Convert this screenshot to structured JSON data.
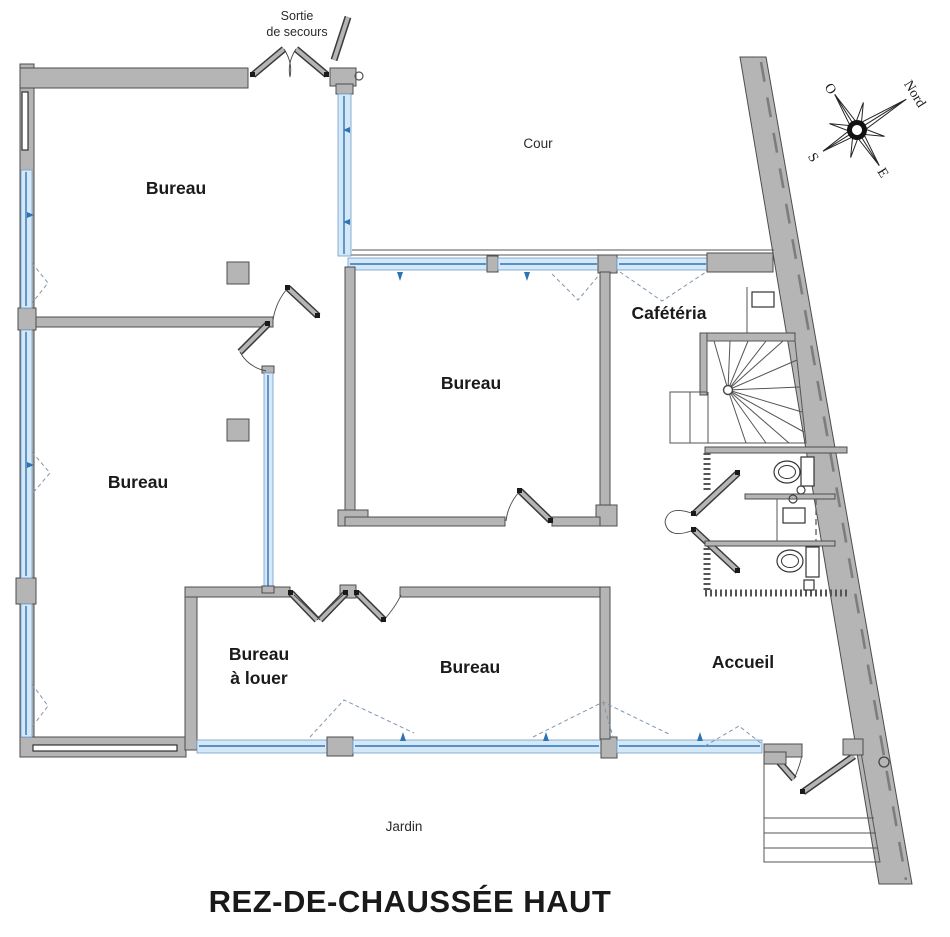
{
  "title": "REZ-DE-CHAUSSÉE HAUT",
  "outdoor": {
    "cour": "Cour",
    "jardin": "Jardin",
    "sortie_line1": "Sortie",
    "sortie_line2": "de secours"
  },
  "rooms": {
    "bureau_top_left": "Bureau",
    "bureau_left": "Bureau",
    "bureau_center": "Bureau",
    "bureau_bottom": "Bureau",
    "bureau_a_louer_line1": "Bureau",
    "bureau_a_louer_line2": "à louer",
    "cafeteria": "Cafétéria",
    "accueil": "Accueil"
  },
  "compass": {
    "north": "Nord",
    "west": "O",
    "south": "S",
    "east": "E"
  },
  "colors": {
    "wall": "#b5b5b5",
    "window_fill": "#d5e8f7",
    "window_line": "#2e74b5",
    "rent_label": "#c62828"
  }
}
